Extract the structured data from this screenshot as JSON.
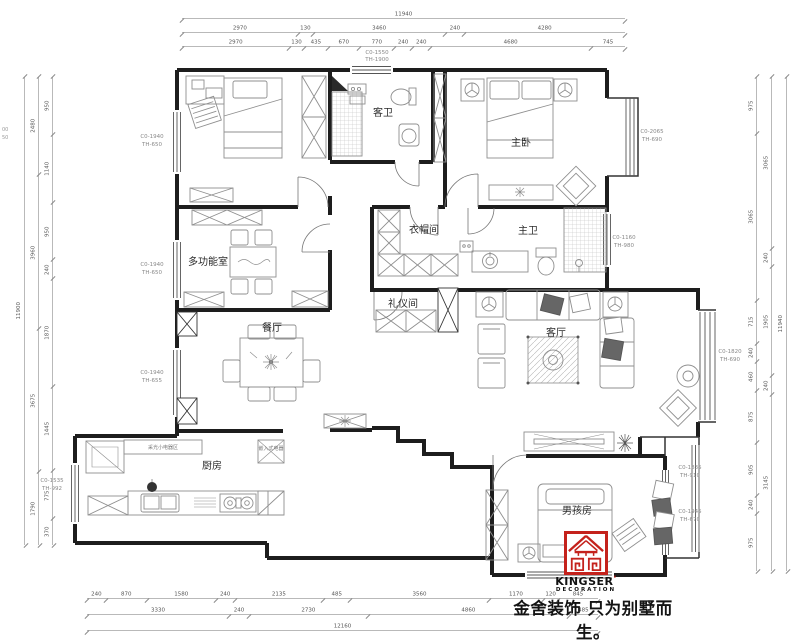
{
  "plan": {
    "rooms": {
      "guest_bath": "客卫",
      "master_bedroom": "主卧",
      "cloakroom": "衣帽间",
      "master_bath": "主卫",
      "multi_function": "多功能室",
      "dining": "餐厅",
      "etiquette": "礼仪间",
      "living": "客厅",
      "kitchen": "厨房",
      "boys_room": "男孩房"
    },
    "notes": {
      "kitchen_counter": "采光小电器区",
      "built_in": "嵌入式电器"
    },
    "windows": {
      "top": {
        "l1": "C0-1550",
        "l2": "TH-1900"
      },
      "left_a": {
        "l1": "C0-1940",
        "l2": "TH-650"
      },
      "left_b": {
        "l1": "C0-1940",
        "l2": "TH-650"
      },
      "left_c": {
        "l1": "C0-1940",
        "l2": "TH-655"
      },
      "left_d": {
        "l1": "C0-1535",
        "l2": "TH-992"
      },
      "right_a": {
        "l1": "C0-2065",
        "l2": "TH-690"
      },
      "right_b": {
        "l1": "C0-1160",
        "l2": "TH-980"
      },
      "right_c": {
        "l1": "C0-1820",
        "l2": "TH-690"
      },
      "right_d": {
        "l1": "C0-1835",
        "l2": "TH-910"
      },
      "right_e": {
        "l1": "C0-1945",
        "l2": "TH-670"
      }
    },
    "edge_labels": [
      "00",
      "50"
    ]
  },
  "dims": {
    "top": [
      [
        "11940"
      ],
      [
        "2970",
        "130",
        "3460",
        "240",
        "4280"
      ],
      [
        "2970",
        "130",
        "435",
        "670",
        "770",
        "240",
        "240",
        "4680",
        "745"
      ]
    ],
    "bottom": [
      [
        "240",
        "870",
        "1580",
        "240",
        "2135",
        "485",
        "3560",
        "1170",
        "120",
        "845"
      ],
      [
        "3330",
        "240",
        "2730",
        "4860",
        "485"
      ],
      [
        "12160"
      ]
    ],
    "left": [
      [
        "11900"
      ],
      [
        "2480",
        "3960",
        "3675",
        "1790"
      ],
      [
        "950",
        "1140",
        "950",
        "240",
        "1870",
        "1445",
        "775",
        "370"
      ]
    ],
    "right": [
      [
        "975",
        "3065",
        "715",
        "240",
        "460",
        "875",
        "905",
        "240",
        "975"
      ],
      [
        "3065",
        "240",
        "1905",
        "240",
        "3145"
      ],
      [
        "11940"
      ]
    ]
  },
  "logo": {
    "brand": "KINGSER",
    "mark": "'",
    "sub": "DECORATION"
  },
  "slogan": "金舍装饰 只为别墅而生。"
}
